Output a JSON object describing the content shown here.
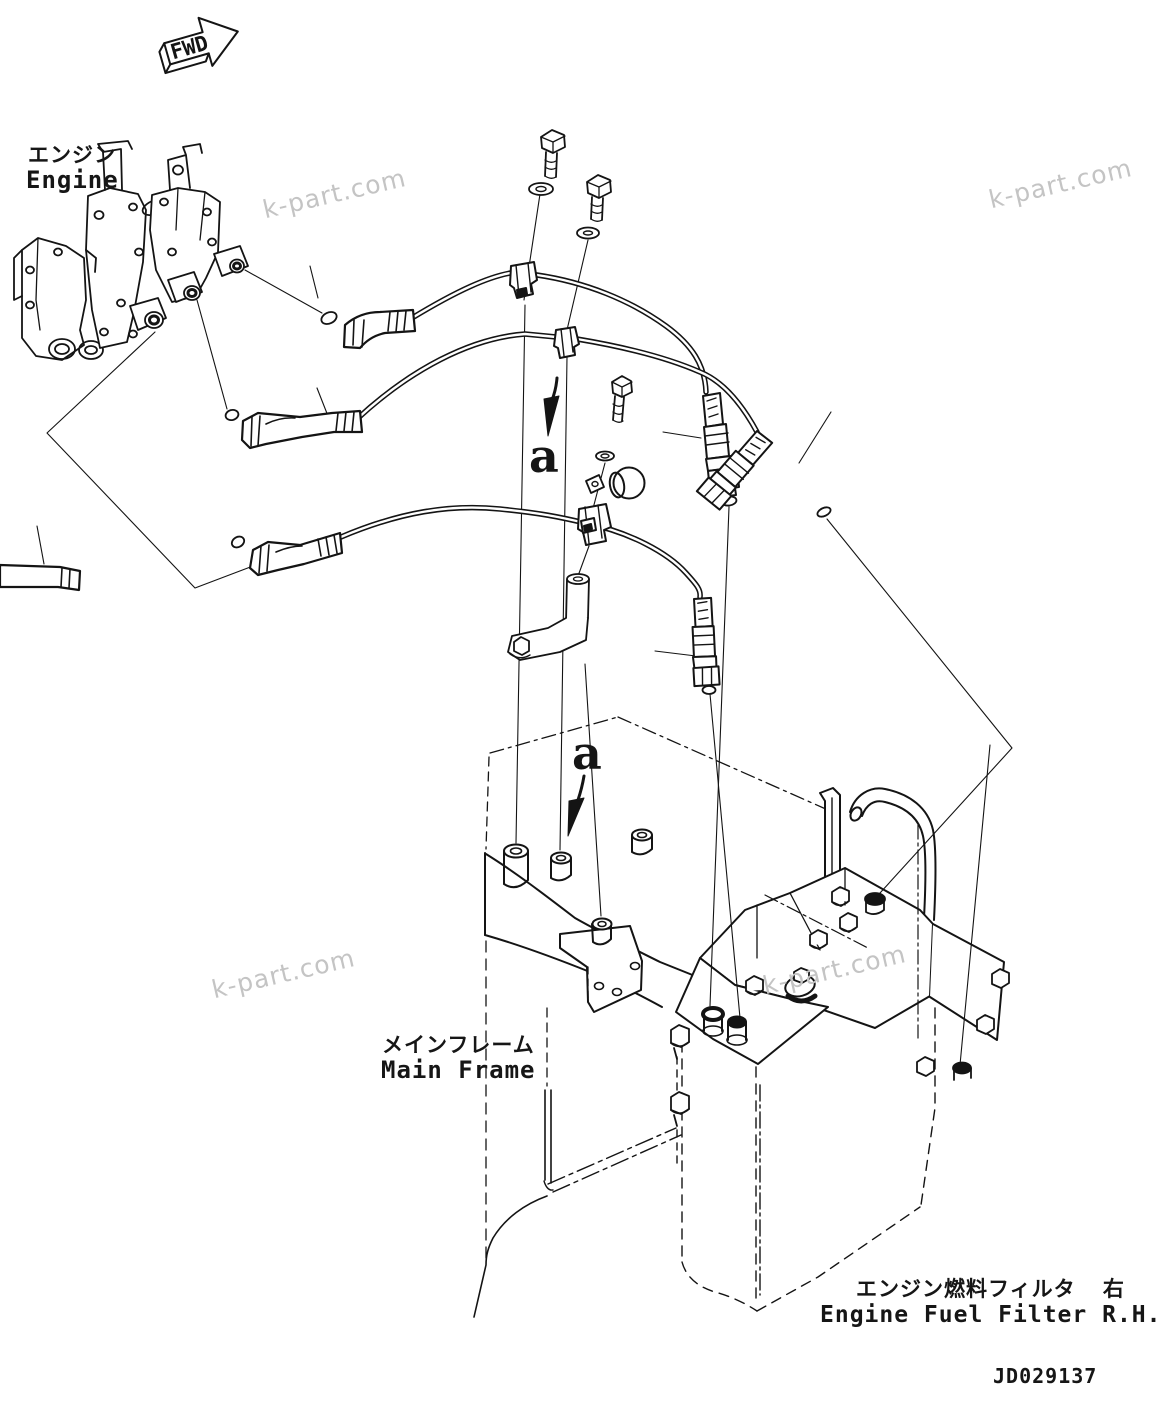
{
  "title_block": {
    "drawing_number": "JD029137"
  },
  "orientation": {
    "fwd_label": "FWD"
  },
  "callouts": {
    "view_label_upper": "a",
    "view_label_lower": "a"
  },
  "component_labels": {
    "engine": {
      "jp": "エンジン",
      "en": "Engine"
    },
    "main_frame": {
      "jp": "メインフレーム",
      "en": "Main Frame"
    },
    "engine_fuel_filter": {
      "jp": "エンジン燃料フィルタ  右",
      "en": "Engine Fuel Filter R.H."
    }
  },
  "watermark": {
    "text": "k-part.com",
    "color": "#c4c4c4",
    "count": 4
  },
  "colors": {
    "line": "#141414",
    "background": "#ffffff"
  }
}
